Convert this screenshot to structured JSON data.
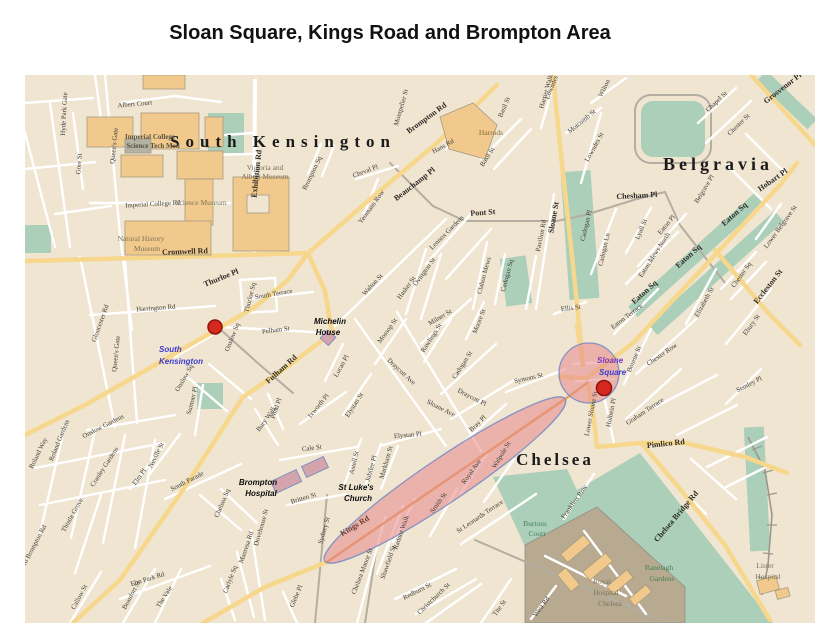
{
  "title": "Sloan Square, Kings Road and Brompton Area",
  "map": {
    "colors": {
      "background": "#f0e5d1",
      "park_green": "#accfb9",
      "road_yellow": "#f7d78c",
      "road_orange": "#e9a55c",
      "road_white": "#ffffff",
      "road_gray": "#b3aea2",
      "building_orange": "#f2c98c",
      "building_lilac": "#d4a4ad",
      "hospital_area": "#b7aa91",
      "highlight_pink": "#e5898d",
      "highlight_stroke": "#7288c4",
      "station_red": "#d5281e",
      "annotation_blue": "#3b3bd0"
    },
    "annotations": {
      "stations": [
        {
          "name": "South Kensington Station",
          "x": 190,
          "y": 252,
          "r": 7
        },
        {
          "name": "Sloane Square Station",
          "x": 579,
          "y": 313,
          "r": 7.5
        }
      ],
      "highlights": [
        {
          "shape": "ellipse",
          "cx": 420,
          "cy": 405,
          "rx": 145,
          "ry": 22,
          "rotate": -34
        },
        {
          "shape": "circle",
          "cx": 564,
          "cy": 298,
          "r": 30
        }
      ]
    },
    "labels": [
      {
        "t": "South Kensington",
        "x": 258,
        "y": 72,
        "k": "dist",
        "s": 17,
        "ls": 6
      },
      {
        "t": "Belgravia",
        "x": 693,
        "y": 95,
        "k": "dist",
        "s": 18,
        "ls": 4
      },
      {
        "t": "Chelsea",
        "x": 530,
        "y": 390,
        "k": "dist",
        "s": 17,
        "ls": 3
      },
      {
        "t": "Imperial College",
        "x": 125,
        "y": 64,
        "k": "placeb"
      },
      {
        "t": "Science Tech Med",
        "x": 128,
        "y": 73,
        "k": "placeb"
      },
      {
        "t": "Victoria and",
        "x": 240,
        "y": 95,
        "k": "place"
      },
      {
        "t": "Albert Museum",
        "x": 240,
        "y": 104,
        "k": "place"
      },
      {
        "t": "Science Museum",
        "x": 176,
        "y": 130,
        "k": "place"
      },
      {
        "t": "Natural History",
        "x": 116,
        "y": 166,
        "k": "place"
      },
      {
        "t": "Museum",
        "x": 122,
        "y": 176,
        "k": "place"
      },
      {
        "t": "Harrods",
        "x": 466,
        "y": 60,
        "k": "place",
        "c": "#8a6a35"
      },
      {
        "t": "Burtons",
        "x": 510,
        "y": 451,
        "k": "place",
        "c": "#47805c"
      },
      {
        "t": "Court",
        "x": 512,
        "y": 461,
        "k": "place",
        "c": "#47805c"
      },
      {
        "t": "Ranelagh",
        "x": 634,
        "y": 495,
        "k": "place",
        "c": "#47805c"
      },
      {
        "t": "Gardens",
        "x": 637,
        "y": 506,
        "k": "place",
        "c": "#47805c"
      },
      {
        "t": "Royal",
        "x": 577,
        "y": 509,
        "k": "place"
      },
      {
        "t": "Hospital",
        "x": 581,
        "y": 520,
        "k": "place"
      },
      {
        "t": "Chelsea",
        "x": 585,
        "y": 531,
        "k": "place"
      },
      {
        "t": "Lister",
        "x": 740,
        "y": 493,
        "k": "place"
      },
      {
        "t": "Hospital",
        "x": 743,
        "y": 504,
        "k": "place"
      },
      {
        "t": "Michelin",
        "x": 305,
        "y": 249,
        "k": "poi"
      },
      {
        "t": "House",
        "x": 303,
        "y": 260,
        "k": "poi"
      },
      {
        "t": "Brompton",
        "x": 233,
        "y": 410,
        "k": "poi"
      },
      {
        "t": "Hospital",
        "x": 236,
        "y": 421,
        "k": "poi"
      },
      {
        "t": "St Luke's",
        "x": 331,
        "y": 415,
        "k": "poi"
      },
      {
        "t": "Church",
        "x": 333,
        "y": 426,
        "k": "poi"
      },
      {
        "t": "South",
        "x": 134,
        "y": 277,
        "k": "stn",
        "c": "#3b3bd0"
      },
      {
        "t": "Kensington",
        "x": 134,
        "y": 289,
        "k": "stn",
        "c": "#3b3bd0"
      },
      {
        "t": "Sloane",
        "x": 572,
        "y": 288,
        "k": "stn",
        "c": "#7b35bd"
      },
      {
        "t": "Square",
        "x": 574,
        "y": 300,
        "k": "stn",
        "c": "#3b3bd0"
      },
      {
        "t": "Cromwell Rd",
        "x": 160,
        "y": 179,
        "r": -2,
        "k": "stb"
      },
      {
        "t": "Thurloe Pl",
        "x": 197,
        "y": 205,
        "r": -22,
        "k": "stb"
      },
      {
        "t": "Brompton Rd",
        "x": 403,
        "y": 45,
        "r": -36,
        "k": "stb"
      },
      {
        "t": "Beauchamp Pl",
        "x": 391,
        "y": 111,
        "r": -38,
        "k": "stb"
      },
      {
        "t": "Pont St",
        "x": 458,
        "y": 140,
        "r": -4,
        "k": "stb"
      },
      {
        "t": "Sloane St",
        "x": 531,
        "y": 143,
        "r": -80,
        "k": "stb"
      },
      {
        "t": "Fulham Rd",
        "x": 258,
        "y": 296,
        "r": -42,
        "k": "stb"
      },
      {
        "t": "Kings Rd",
        "x": 331,
        "y": 453,
        "r": -31,
        "k": "stb",
        "c": "#6b3a31"
      },
      {
        "t": "Pimlico Rd",
        "x": 641,
        "y": 371,
        "r": -6,
        "k": "stb"
      },
      {
        "t": "Chelsea Bridge Rd",
        "x": 653,
        "y": 443,
        "r": -50,
        "k": "stb"
      },
      {
        "t": "Eccleston St",
        "x": 745,
        "y": 213,
        "r": -52,
        "k": "stb"
      },
      {
        "t": "Chesham Pl",
        "x": 612,
        "y": 123,
        "r": -3,
        "k": "stb"
      },
      {
        "t": "Eaton Sq",
        "x": 621,
        "y": 219,
        "r": -42,
        "k": "stb"
      },
      {
        "t": "Eaton Sq",
        "x": 665,
        "y": 183,
        "r": -42,
        "k": "stb"
      },
      {
        "t": "Eaton Sq",
        "x": 711,
        "y": 141,
        "r": -42,
        "k": "stb"
      },
      {
        "t": "Grosvenor Pl",
        "x": 759,
        "y": 15,
        "r": -38,
        "k": "stb"
      },
      {
        "t": "Hobart Pl",
        "x": 749,
        "y": 107,
        "r": -35,
        "k": "stb"
      },
      {
        "t": "Exhibition Rd",
        "x": 234,
        "y": 99,
        "r": -84,
        "k": "stb"
      },
      {
        "t": "Hyde Park Gate",
        "x": 41,
        "y": 39,
        "r": -87
      },
      {
        "t": "Queen's Gate",
        "x": 91,
        "y": 71,
        "r": -84
      },
      {
        "t": "Gore St",
        "x": 56,
        "y": 89,
        "r": -86
      },
      {
        "t": "Albert Court",
        "x": 110,
        "y": 31,
        "r": -5
      },
      {
        "t": "Imperial College Rd",
        "x": 128,
        "y": 131,
        "r": -3
      },
      {
        "t": "Harrington Rd",
        "x": 131,
        "y": 235,
        "r": -4
      },
      {
        "t": "Gloucester Rd",
        "x": 77,
        "y": 249,
        "r": -70
      },
      {
        "t": "Queen's Gate",
        "x": 93,
        "y": 279,
        "r": -84
      },
      {
        "t": "Thurloe Sq",
        "x": 227,
        "y": 223,
        "r": -76
      },
      {
        "t": "Onslow Sq",
        "x": 209,
        "y": 263,
        "r": -68
      },
      {
        "t": "Onslow Sq",
        "x": 161,
        "y": 304,
        "r": -60
      },
      {
        "t": "Sumner Pl",
        "x": 169,
        "y": 326,
        "r": -76
      },
      {
        "t": "South Terrace",
        "x": 249,
        "y": 221,
        "r": -10
      },
      {
        "t": "Pelham St",
        "x": 251,
        "y": 257,
        "r": -7
      },
      {
        "t": "Old Brompton Rd",
        "x": 10,
        "y": 473,
        "r": -62
      },
      {
        "t": "Onslow Gardens",
        "x": 79,
        "y": 353,
        "r": -27
      },
      {
        "t": "Roland Gardens",
        "x": 36,
        "y": 366,
        "r": -68
      },
      {
        "t": "Roland Way",
        "x": 15,
        "y": 379,
        "r": -64
      },
      {
        "t": "Cranley Gardens",
        "x": 81,
        "y": 393,
        "r": -57
      },
      {
        "t": "Neville St",
        "x": 133,
        "y": 381,
        "r": -63
      },
      {
        "t": "Elm Pl",
        "x": 116,
        "y": 403,
        "r": -54
      },
      {
        "t": "South Parade",
        "x": 163,
        "y": 408,
        "r": -27
      },
      {
        "t": "Thistle Grove",
        "x": 49,
        "y": 441,
        "r": -61
      },
      {
        "t": "Elm Park Rd",
        "x": 123,
        "y": 506,
        "r": -17
      },
      {
        "t": "The Vale",
        "x": 141,
        "y": 523,
        "r": -57
      },
      {
        "t": "Beaufort St",
        "x": 108,
        "y": 521,
        "r": -62
      },
      {
        "t": "Callow St",
        "x": 56,
        "y": 523,
        "r": -62
      },
      {
        "t": "Chelsea Sq",
        "x": 199,
        "y": 429,
        "r": -67
      },
      {
        "t": "Dovehouse St",
        "x": 238,
        "y": 453,
        "r": -74
      },
      {
        "t": "Manresa Rd",
        "x": 223,
        "y": 473,
        "r": -71
      },
      {
        "t": "Carlyle Sq",
        "x": 207,
        "y": 505,
        "r": -69
      },
      {
        "t": "Glebe Pl",
        "x": 273,
        "y": 522,
        "r": -67
      },
      {
        "t": "Sydney St",
        "x": 301,
        "y": 456,
        "r": -74
      },
      {
        "t": "Britten St",
        "x": 279,
        "y": 425,
        "r": -17
      },
      {
        "t": "Cale St",
        "x": 287,
        "y": 375,
        "r": -7
      },
      {
        "t": "Bury Walk",
        "x": 243,
        "y": 345,
        "r": -54
      },
      {
        "t": "Pond Pl",
        "x": 253,
        "y": 334,
        "r": -71
      },
      {
        "t": "Ixworth Pl",
        "x": 295,
        "y": 332,
        "r": -51
      },
      {
        "t": "Lucan Pl",
        "x": 318,
        "y": 292,
        "r": -61
      },
      {
        "t": "Elystan St",
        "x": 331,
        "y": 331,
        "r": -57
      },
      {
        "t": "Elystan Pl",
        "x": 383,
        "y": 362,
        "r": -5
      },
      {
        "t": "Mossop St",
        "x": 364,
        "y": 257,
        "r": -54
      },
      {
        "t": "Draycott Ave",
        "x": 375,
        "y": 298,
        "r": 43
      },
      {
        "t": "Sloane Ave",
        "x": 415,
        "y": 335,
        "r": 27
      },
      {
        "t": "Walton St",
        "x": 349,
        "y": 211,
        "r": -47
      },
      {
        "t": "Ovington St",
        "x": 401,
        "y": 198,
        "r": -54
      },
      {
        "t": "Hasker St",
        "x": 383,
        "y": 214,
        "r": -54
      },
      {
        "t": "Milner St",
        "x": 416,
        "y": 244,
        "r": -31
      },
      {
        "t": "Moore St",
        "x": 456,
        "y": 247,
        "r": -69
      },
      {
        "t": "Rawlings St",
        "x": 408,
        "y": 264,
        "r": -57
      },
      {
        "t": "Clabon Mews",
        "x": 461,
        "y": 201,
        "r": -75
      },
      {
        "t": "Cadogan Sq",
        "x": 484,
        "y": 201,
        "r": -75
      },
      {
        "t": "Lennox Gardens",
        "x": 423,
        "y": 159,
        "r": -45
      },
      {
        "t": "Pavilion Rd",
        "x": 518,
        "y": 161,
        "r": -79
      },
      {
        "t": "Cadogan Pl",
        "x": 563,
        "y": 151,
        "r": -77
      },
      {
        "t": "Cadogan Ln",
        "x": 581,
        "y": 175,
        "r": -77
      },
      {
        "t": "Ellis St",
        "x": 546,
        "y": 235,
        "r": -7
      },
      {
        "t": "Cadogan St",
        "x": 439,
        "y": 291,
        "r": -57
      },
      {
        "t": "Draycott Pl",
        "x": 446,
        "y": 324,
        "r": 27
      },
      {
        "t": "Bray Pl",
        "x": 454,
        "y": 350,
        "r": -44
      },
      {
        "t": "Symons St",
        "x": 504,
        "y": 305,
        "r": -13
      },
      {
        "t": "Montpelier St",
        "x": 378,
        "y": 33,
        "r": -74
      },
      {
        "t": "Hans Rd",
        "x": 419,
        "y": 73,
        "r": -29
      },
      {
        "t": "Harriet Walk",
        "x": 523,
        "y": 17,
        "r": -74
      },
      {
        "t": "Basil St",
        "x": 481,
        "y": 33,
        "r": -67
      },
      {
        "t": "Basil St",
        "x": 464,
        "y": 83,
        "r": -57
      },
      {
        "t": "Cheval Pl",
        "x": 341,
        "y": 98,
        "r": -21
      },
      {
        "t": "Brompton Sq",
        "x": 289,
        "y": 99,
        "r": -64
      },
      {
        "t": "Yeomans Row",
        "x": 348,
        "y": 133,
        "r": -54
      },
      {
        "t": "Wilton",
        "x": 581,
        "y": 14,
        "r": -64
      },
      {
        "t": "Motcomb St",
        "x": 558,
        "y": 48,
        "r": -39
      },
      {
        "t": "Lowndes St",
        "x": 571,
        "y": 73,
        "r": -61
      },
      {
        "t": "Lowndes Sq",
        "x": 530,
        "y": 9,
        "r": -69
      },
      {
        "t": "Chapel St",
        "x": 693,
        "y": 28,
        "r": -44
      },
      {
        "t": "Chester St",
        "x": 715,
        "y": 51,
        "r": -44
      },
      {
        "t": "Belgrave Pl",
        "x": 681,
        "y": 115,
        "r": -59
      },
      {
        "t": "Lyall St",
        "x": 618,
        "y": 155,
        "r": -67
      },
      {
        "t": "Eaton Pl",
        "x": 643,
        "y": 151,
        "r": -51
      },
      {
        "t": "Eaton Mews North",
        "x": 631,
        "y": 181,
        "r": -57
      },
      {
        "t": "Eaton Terrace",
        "x": 603,
        "y": 243,
        "r": -37
      },
      {
        "t": "Elizabeth St",
        "x": 681,
        "y": 228,
        "r": -61
      },
      {
        "t": "Chester Sq",
        "x": 718,
        "y": 201,
        "r": -54
      },
      {
        "t": "Ebury St",
        "x": 728,
        "y": 251,
        "r": -54
      },
      {
        "t": "Lower Belgrave St",
        "x": 757,
        "y": 153,
        "r": -54
      },
      {
        "t": "Semley Pl",
        "x": 725,
        "y": 311,
        "r": -27
      },
      {
        "t": "Chester Row",
        "x": 638,
        "y": 281,
        "r": -34
      },
      {
        "t": "Bourne St",
        "x": 611,
        "y": 285,
        "r": -67
      },
      {
        "t": "Graham Terrace",
        "x": 621,
        "y": 338,
        "r": -34
      },
      {
        "t": "Holbein Pl",
        "x": 588,
        "y": 338,
        "r": -79
      },
      {
        "t": "Lower Sloane St",
        "x": 568,
        "y": 339,
        "r": -79
      },
      {
        "t": "Franklins Row",
        "x": 551,
        "y": 428,
        "r": -54
      },
      {
        "t": "Royal Ave",
        "x": 448,
        "y": 398,
        "r": -54
      },
      {
        "t": "Walpole St",
        "x": 478,
        "y": 381,
        "r": -59
      },
      {
        "t": "Smith St",
        "x": 415,
        "y": 429,
        "r": -54
      },
      {
        "t": "Radnor Walk",
        "x": 378,
        "y": 458,
        "r": -71
      },
      {
        "t": "Shawfield St",
        "x": 365,
        "y": 488,
        "r": -71
      },
      {
        "t": "Chelsea Manor St",
        "x": 339,
        "y": 497,
        "r": -69
      },
      {
        "t": "Markham St",
        "x": 363,
        "y": 388,
        "r": -74
      },
      {
        "t": "Jubilee Pl",
        "x": 348,
        "y": 394,
        "r": -74
      },
      {
        "t": "Astell St",
        "x": 331,
        "y": 388,
        "r": -77
      },
      {
        "t": "Redburn St",
        "x": 393,
        "y": 518,
        "r": -27
      },
      {
        "t": "Christchurch St",
        "x": 410,
        "y": 525,
        "r": -44
      },
      {
        "t": "St Leonards Terrace",
        "x": 456,
        "y": 443,
        "r": -34
      },
      {
        "t": "Tite St",
        "x": 476,
        "y": 534,
        "r": -54
      },
      {
        "t": "West Rd",
        "x": 518,
        "y": 533,
        "r": -54
      }
    ]
  }
}
